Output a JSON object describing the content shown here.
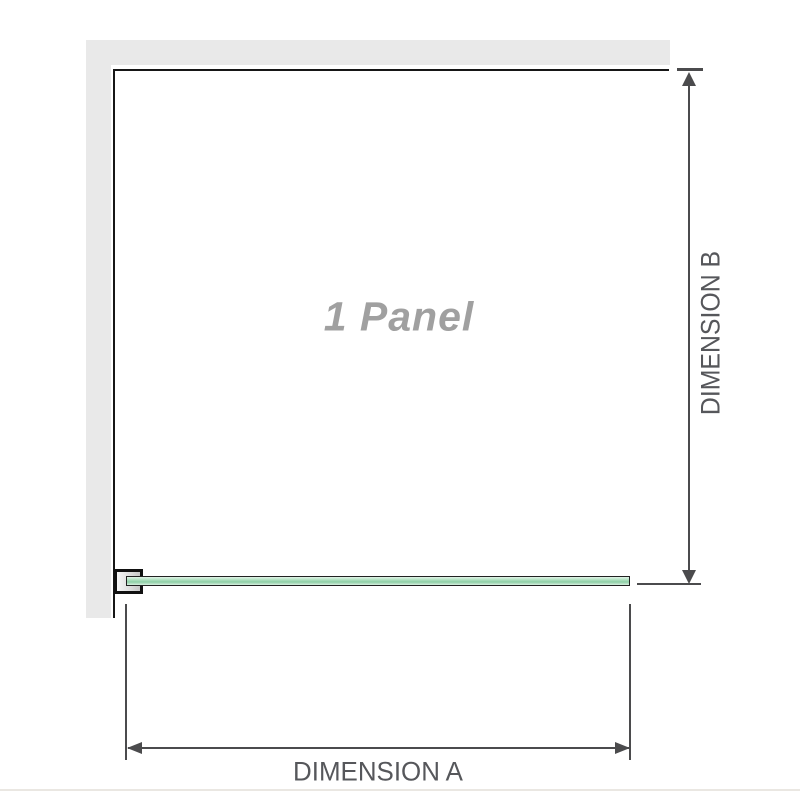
{
  "diagram": {
    "title": "Shower screen single panel plan diagram",
    "panel_label": "1 Panel",
    "dimension_a": {
      "label": "DIMENSION A",
      "orientation": "horizontal",
      "measures": "glass panel width"
    },
    "dimension_b": {
      "label": "DIMENSION B",
      "orientation": "vertical",
      "measures": "enclosure depth from back wall to glass"
    }
  },
  "colors": {
    "background": "#ffffff",
    "wall_fill": "#e9e9e9",
    "enclosure_outline": "#161616",
    "dimension_line": "#4b4b4d",
    "dimension_text": "#56575b",
    "panel_text": "#a0a0a0",
    "glass_green": "#8ecfa6",
    "glass_green_light": "#d7efe0",
    "bracket_fill": "#d9d9d9",
    "baseline": "#eae7e2"
  }
}
